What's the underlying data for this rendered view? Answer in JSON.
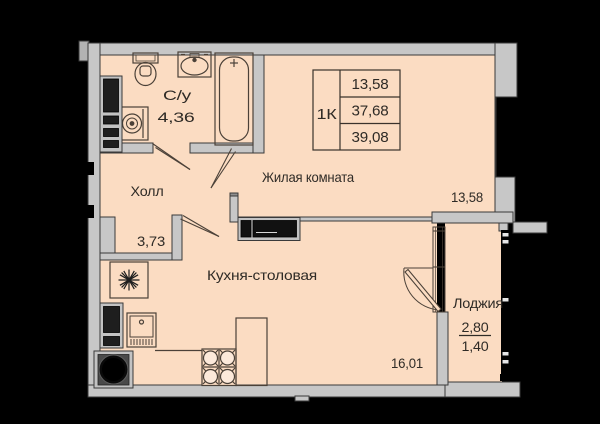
{
  "colors": {
    "background": "#000000",
    "floor": "#fbdcc2",
    "wall_fill": "#c7c7c7",
    "wall_outline": "#3a3a3a",
    "fixture_line": "#4b4138",
    "text": "#2f2b26",
    "appliance_dark": "#1e1e1e",
    "glazing": "#000000"
  },
  "summary_table": {
    "type_label": "1К",
    "values": [
      "13,58",
      "37,68",
      "39,08"
    ]
  },
  "rooms": {
    "bathroom": {
      "name": "С/у",
      "area": "4,36"
    },
    "hall": {
      "name": "Холл",
      "area": "3,73"
    },
    "living_room": {
      "name": "Жилая комната",
      "area": "13,58"
    },
    "kitchen_dining": {
      "name": "Кухня-столовая",
      "area": "16,01"
    },
    "loggia": {
      "name": "Лоджия",
      "area_total": "2,80",
      "area_reduced": "1,40"
    }
  }
}
